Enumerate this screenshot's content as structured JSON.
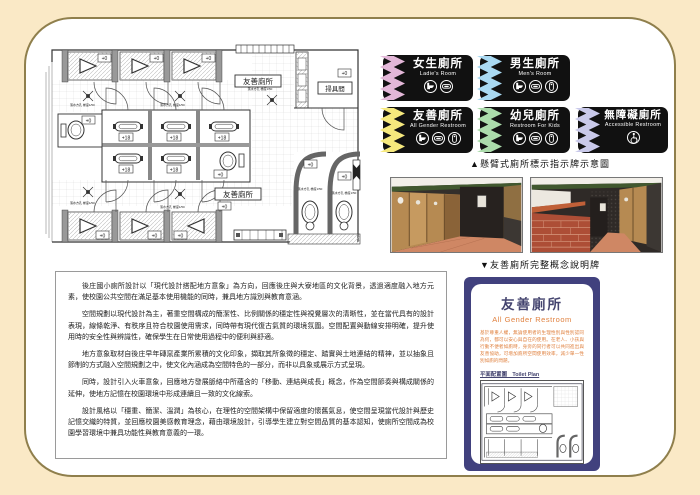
{
  "plan": {
    "room_label_top": "友善廁所",
    "room_label_bottom": "友善廁所",
    "tool_room_label": "掃具間",
    "level_zero": "+0",
    "level_raised": "+18",
    "drain_note": "落水方孔 梯度1/50"
  },
  "signs": {
    "caption": "▲懸臂式廁所標示指示牌示意圖",
    "items": [
      {
        "title": "女生廁所",
        "subtitle": "Ladie's Room",
        "strip_color": "#E3B7D8",
        "icons": [
          "toilet-icon",
          "squat-toilet-icon"
        ]
      },
      {
        "title": "男生廁所",
        "subtitle": "Men's Room",
        "strip_color": "#A9D9F2",
        "icons": [
          "toilet-icon",
          "squat-toilet-icon",
          "urinal-icon"
        ]
      },
      {
        "title": "友善廁所",
        "subtitle": "All Gender Restroom",
        "strip_color": "#F6E97D",
        "icons": [
          "toilet-icon",
          "squat-toilet-icon",
          "urinal-icon"
        ]
      },
      {
        "title": "幼兒廁所",
        "subtitle": "Restroom For Kids",
        "strip_color": "#ABDBAB",
        "icons": [
          "toilet-icon",
          "squat-toilet-icon",
          "urinal-icon"
        ]
      },
      {
        "title": "無障礙廁所",
        "subtitle": "Accessible Restroom",
        "strip_color": "#C9C9EA",
        "icons": [
          "wheelchair-icon"
        ]
      }
    ]
  },
  "photos": {
    "caption": "▼友善廁所完整概念說明牌"
  },
  "description": {
    "paragraphs": [
      "後庄國小廁所設計以「現代設計搭配地方意象」為方向，回應後庄與大寮地區的文化背景，透過適度融入地方元素，使校園公共空間在滿足基本使用機能的同時，兼具地方識別與教育意涵。",
      "空間規劃以現代設計為主，著重空間構成的簡潔性、比例關係的穩定性與視覺層次的清晰性，並在當代具有的設計表現，線條乾淨、有秩序且符合校園使用需求，同時帶有現代復古氣質的環境氛圍。空間配置與動線安排明確，提升使用時的安全性與辨識性，確保學生在日常使用過程中的便利與舒適。",
      "地方意象取材自後庄早年磚窯產業所累積的文化印象，擷取其所象徵的穩定、踏實與土地連結的精神，並以抽象且節制的方式融入空間規劃之中，使文化內涵成為空間特色的一部分，而非以具象或展示方式呈現。",
      "同時，設計引入火車意象，回應地方發展脈絡中所蘊含的「移動、連結與成長」概念，作為空間節奏與構成關係的延伸，使地方記憶在校園環境中形成連續且一致的文化線索。",
      "設計風格以「穩重、簡潔、溫潤」為核心，在理性的空間架構中保留適度的懷舊氣息，使空間呈現當代設計與歷史記憶交織的特質，並回應校園美感教育理念，藉由環境設計，引導學生建立對空間品質的基本認知，使廁所空間成為校園學習環境中兼具功能性與教育意義的一環。"
    ]
  },
  "poster": {
    "title": "友善廁所",
    "subtitle": "All Gender Restroom",
    "body": "基於尊重人權，無論使用者的生理性別與性別認同為何，都可以安心與自在的使用。在老人、小孩與行動不便者如廁時，身旁的同行者可以共同進出與友善協助，可增加廁所空間使用效率，減少單一性別如廁的問題。",
    "plan_label": "平面配置圖　Toilet Plan"
  },
  "colors": {
    "page_background": "#FAE9C6",
    "panel_border": "#8F7F4C",
    "sign_black": "#111111",
    "sign_pink": "#E3B7D8",
    "sign_blue": "#A9D9F2",
    "sign_yellow": "#F6E97D",
    "sign_green": "#ABDBAB",
    "sign_lavender": "#C9C9EA",
    "poster_navy": "#41417E",
    "poster_orange": "#E0813F"
  }
}
